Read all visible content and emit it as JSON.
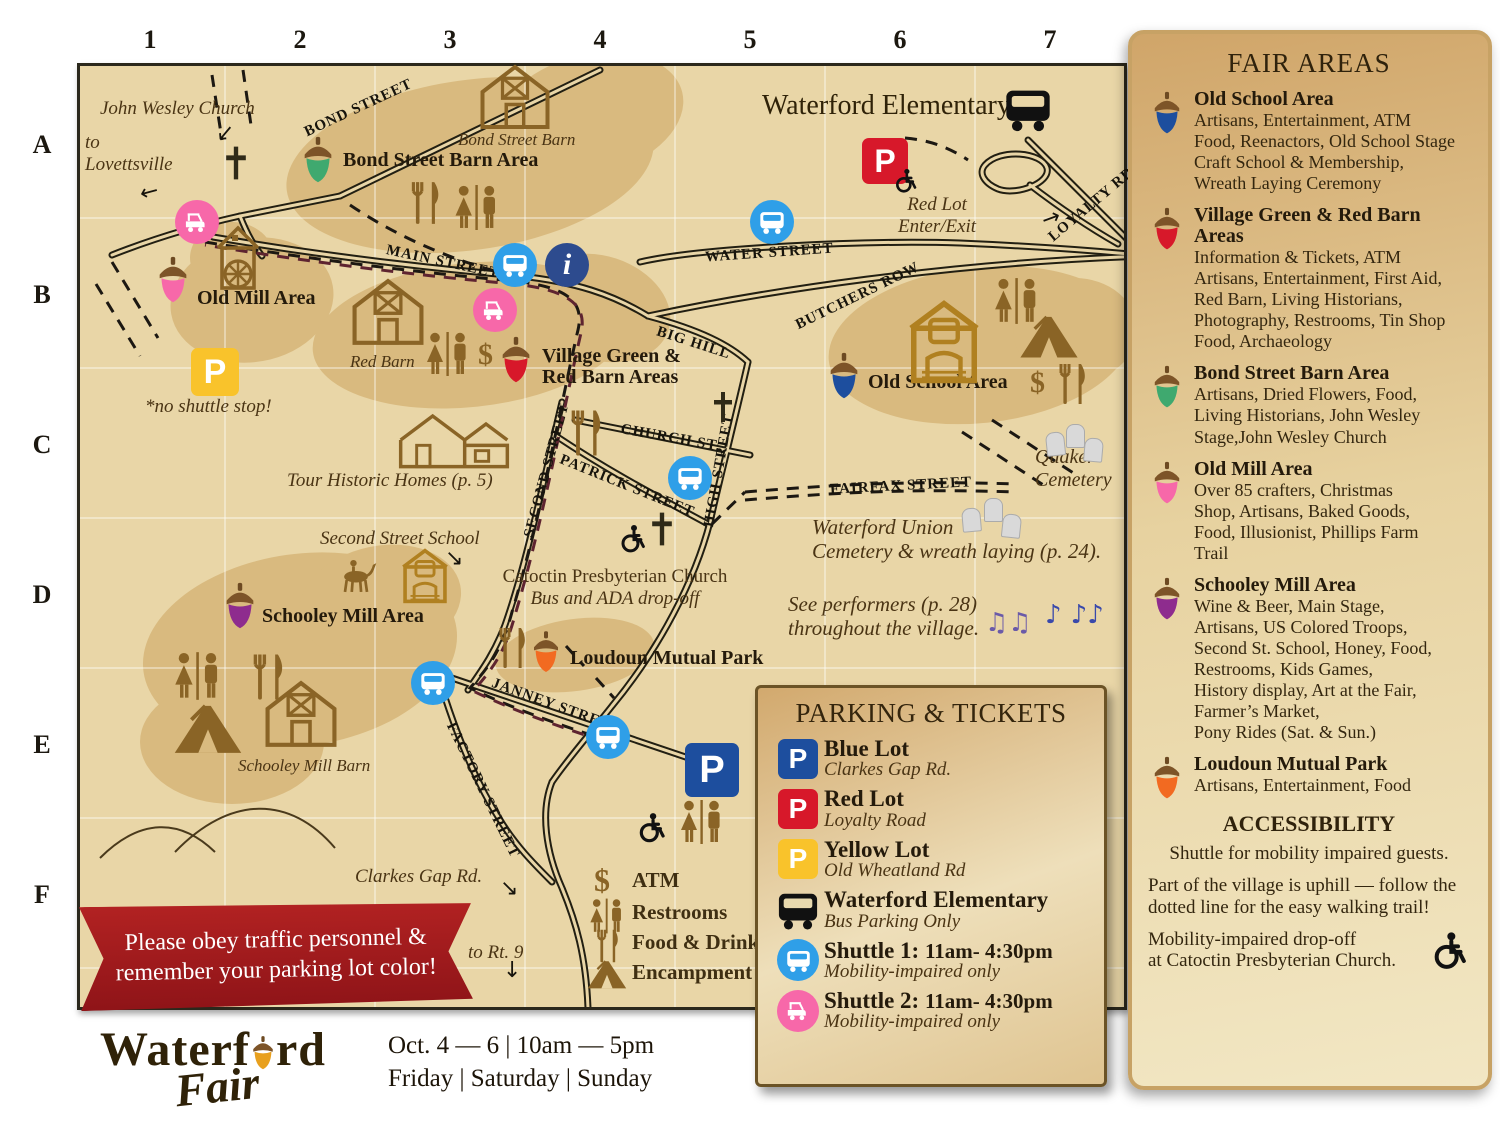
{
  "grid": {
    "cols": [
      "1",
      "2",
      "3",
      "4",
      "5",
      "6",
      "7"
    ],
    "rows": [
      "A",
      "B",
      "C",
      "D",
      "E",
      "F"
    ]
  },
  "icons": {
    "p": "P",
    "i": "i",
    "dollar": "$",
    "notes_a": "♫♫",
    "notes_b": "♪ ♪♪",
    "arrow_left": "←",
    "arrow_right": "→",
    "arrow_down": "↓",
    "arrow_down_right": "↘"
  },
  "colors": {
    "map_bg": "#e9d6a7",
    "area_blob": "#d9ba7f",
    "blue": "#1d4e9e",
    "red": "#d7182a",
    "yellow": "#f9c32b",
    "green": "#3fa96f",
    "pink": "#f768a9",
    "purple": "#8e2c8e",
    "orange": "#f26a21",
    "shuttle_blue": "#2f9fe8",
    "info_navy": "#2d4b8e",
    "banner_red": "#a6191f"
  },
  "map": {
    "streets": {
      "bond": "BOND STREET",
      "main": "MAIN STREET",
      "water": "WATER STREET",
      "butchers": "BUTCHERS ROW",
      "big_hill": "BIG HILL",
      "loyalty": "LOYALTY RD.",
      "church_st": "CHURCH ST.",
      "patrick": "PATRICK STREET",
      "second": "SECOND STREET",
      "high": "HIGH STREET",
      "fairfax": "FAIRFAX STREET",
      "janney": "JANNEY STREET",
      "factory": "FACTORY STREET"
    },
    "areas": {
      "bond": "Bond Street Barn Area",
      "old_mill": "Old Mill Area",
      "village": "Village Green &\nRed Barn Areas",
      "old_school": "Old School Area",
      "schooley": "Schooley Mill Area",
      "loudoun": "Loudoun Mutual Park"
    },
    "labels": {
      "john_wesley": "John Wesley Church",
      "to_lovettsville": "to\nLovettsville",
      "no_shuttle": "*no shuttle stop!",
      "bond_barn": "Bond Street Barn",
      "red_barn": "Red Barn",
      "tour_homes": "Tour Historic Homes (p. 5)",
      "second_school": "Second Street School",
      "schooley_barn": "Schooley Mill Barn",
      "clarkes_gap": "Clarkes Gap Rd.",
      "to_rt9": "to Rt. 9",
      "red_lot": "Red Lot\nEnter/Exit",
      "waterford_elem": "Waterford Elementary",
      "quaker": "Quaker\nCemetery",
      "union_cemetery": "Waterford Union\nCemetery & wreath laying (p. 24).",
      "performers": "See performers (p. 28)\nthroughout the village.",
      "catoctin_line1": "Catoctin Presbyterian Church",
      "catoctin_line2": "Bus and ADA drop-off"
    },
    "legend": {
      "atm": "ATM",
      "restrooms": "Restrooms",
      "food": "Food & Drink",
      "encampment": "Encampment"
    }
  },
  "sidebar": {
    "title": "FAIR AREAS",
    "areas": [
      {
        "name": "Old School Area",
        "color": "#1d4e9e",
        "desc": "Artisans, Entertainment, ATM\nFood, Reenactors, Old School Stage\nCraft School & Membership,\nWreath Laying Ceremony"
      },
      {
        "name": "Village Green & Red Barn Areas",
        "color": "#d7182a",
        "desc": "Information & Tickets, ATM\nArtisans, Entertainment, First Aid,\nRed Barn, Living Historians,\nPhotography, Restrooms, Tin Shop\nFood, Archaeology"
      },
      {
        "name": "Bond Street Barn Area",
        "color": "#3fa96f",
        "desc": "Artisans, Dried Flowers, Food,\nLiving Historians,  John Wesley\nStage,John Wesley Church"
      },
      {
        "name": "Old Mill Area",
        "color": "#f768a9",
        "desc": "Over 85 crafters, Christmas\nShop, Artisans, Baked Goods,\nFood, Illusionist, Phillips Farm\nTrail"
      },
      {
        "name": "Schooley Mill Area",
        "color": "#8e2c8e",
        "desc": "Wine & Beer, Main Stage,\nArtisans, US Colored Troops,\nSecond St. School, Honey, Food,\nRestrooms, Kids Games,\nHistory display, Art at the Fair,\nFarmer’s Market,\nPony Rides (Sat. & Sun.)"
      },
      {
        "name": "Loudoun Mutual Park",
        "color": "#f26a21",
        "desc": "Artisans, Entertainment, Food"
      }
    ],
    "accessibility": {
      "title": "ACCESSIBILITY",
      "p1": "Shuttle for mobility impaired guests.",
      "p2": "Part of the village is uphill — follow the dotted line for the easy walking trail!",
      "p3": "Mobility-impaired drop-off\nat Catoctin Presbyterian Church."
    }
  },
  "parking": {
    "title": "PARKING & TICKETS",
    "rows": [
      {
        "name": "Blue Lot",
        "sub": "Clarkes Gap Rd."
      },
      {
        "name": "Red Lot",
        "sub": "Loyalty Road"
      },
      {
        "name": "Yellow Lot",
        "sub": "Old Wheatland Rd"
      },
      {
        "name": "Waterford Elementary",
        "sub": "Bus Parking Only"
      },
      {
        "name": "Shuttle 1:",
        "time": "11am- 4:30pm",
        "sub": "Mobility-impaired only"
      },
      {
        "name": "Shuttle 2:",
        "time": "11am- 4:30pm",
        "sub": "Mobility-impaired only"
      }
    ]
  },
  "banner": {
    "text": "Please obey traffic personnel &\nremember your parking lot color!"
  },
  "footer": {
    "logo_start": "Waterf",
    "logo_end": "rd",
    "logo_script": "Fair",
    "dates1": "Oct. 4 — 6 | 10am — 5pm",
    "dates2": "Friday | Saturday | Sunday"
  }
}
